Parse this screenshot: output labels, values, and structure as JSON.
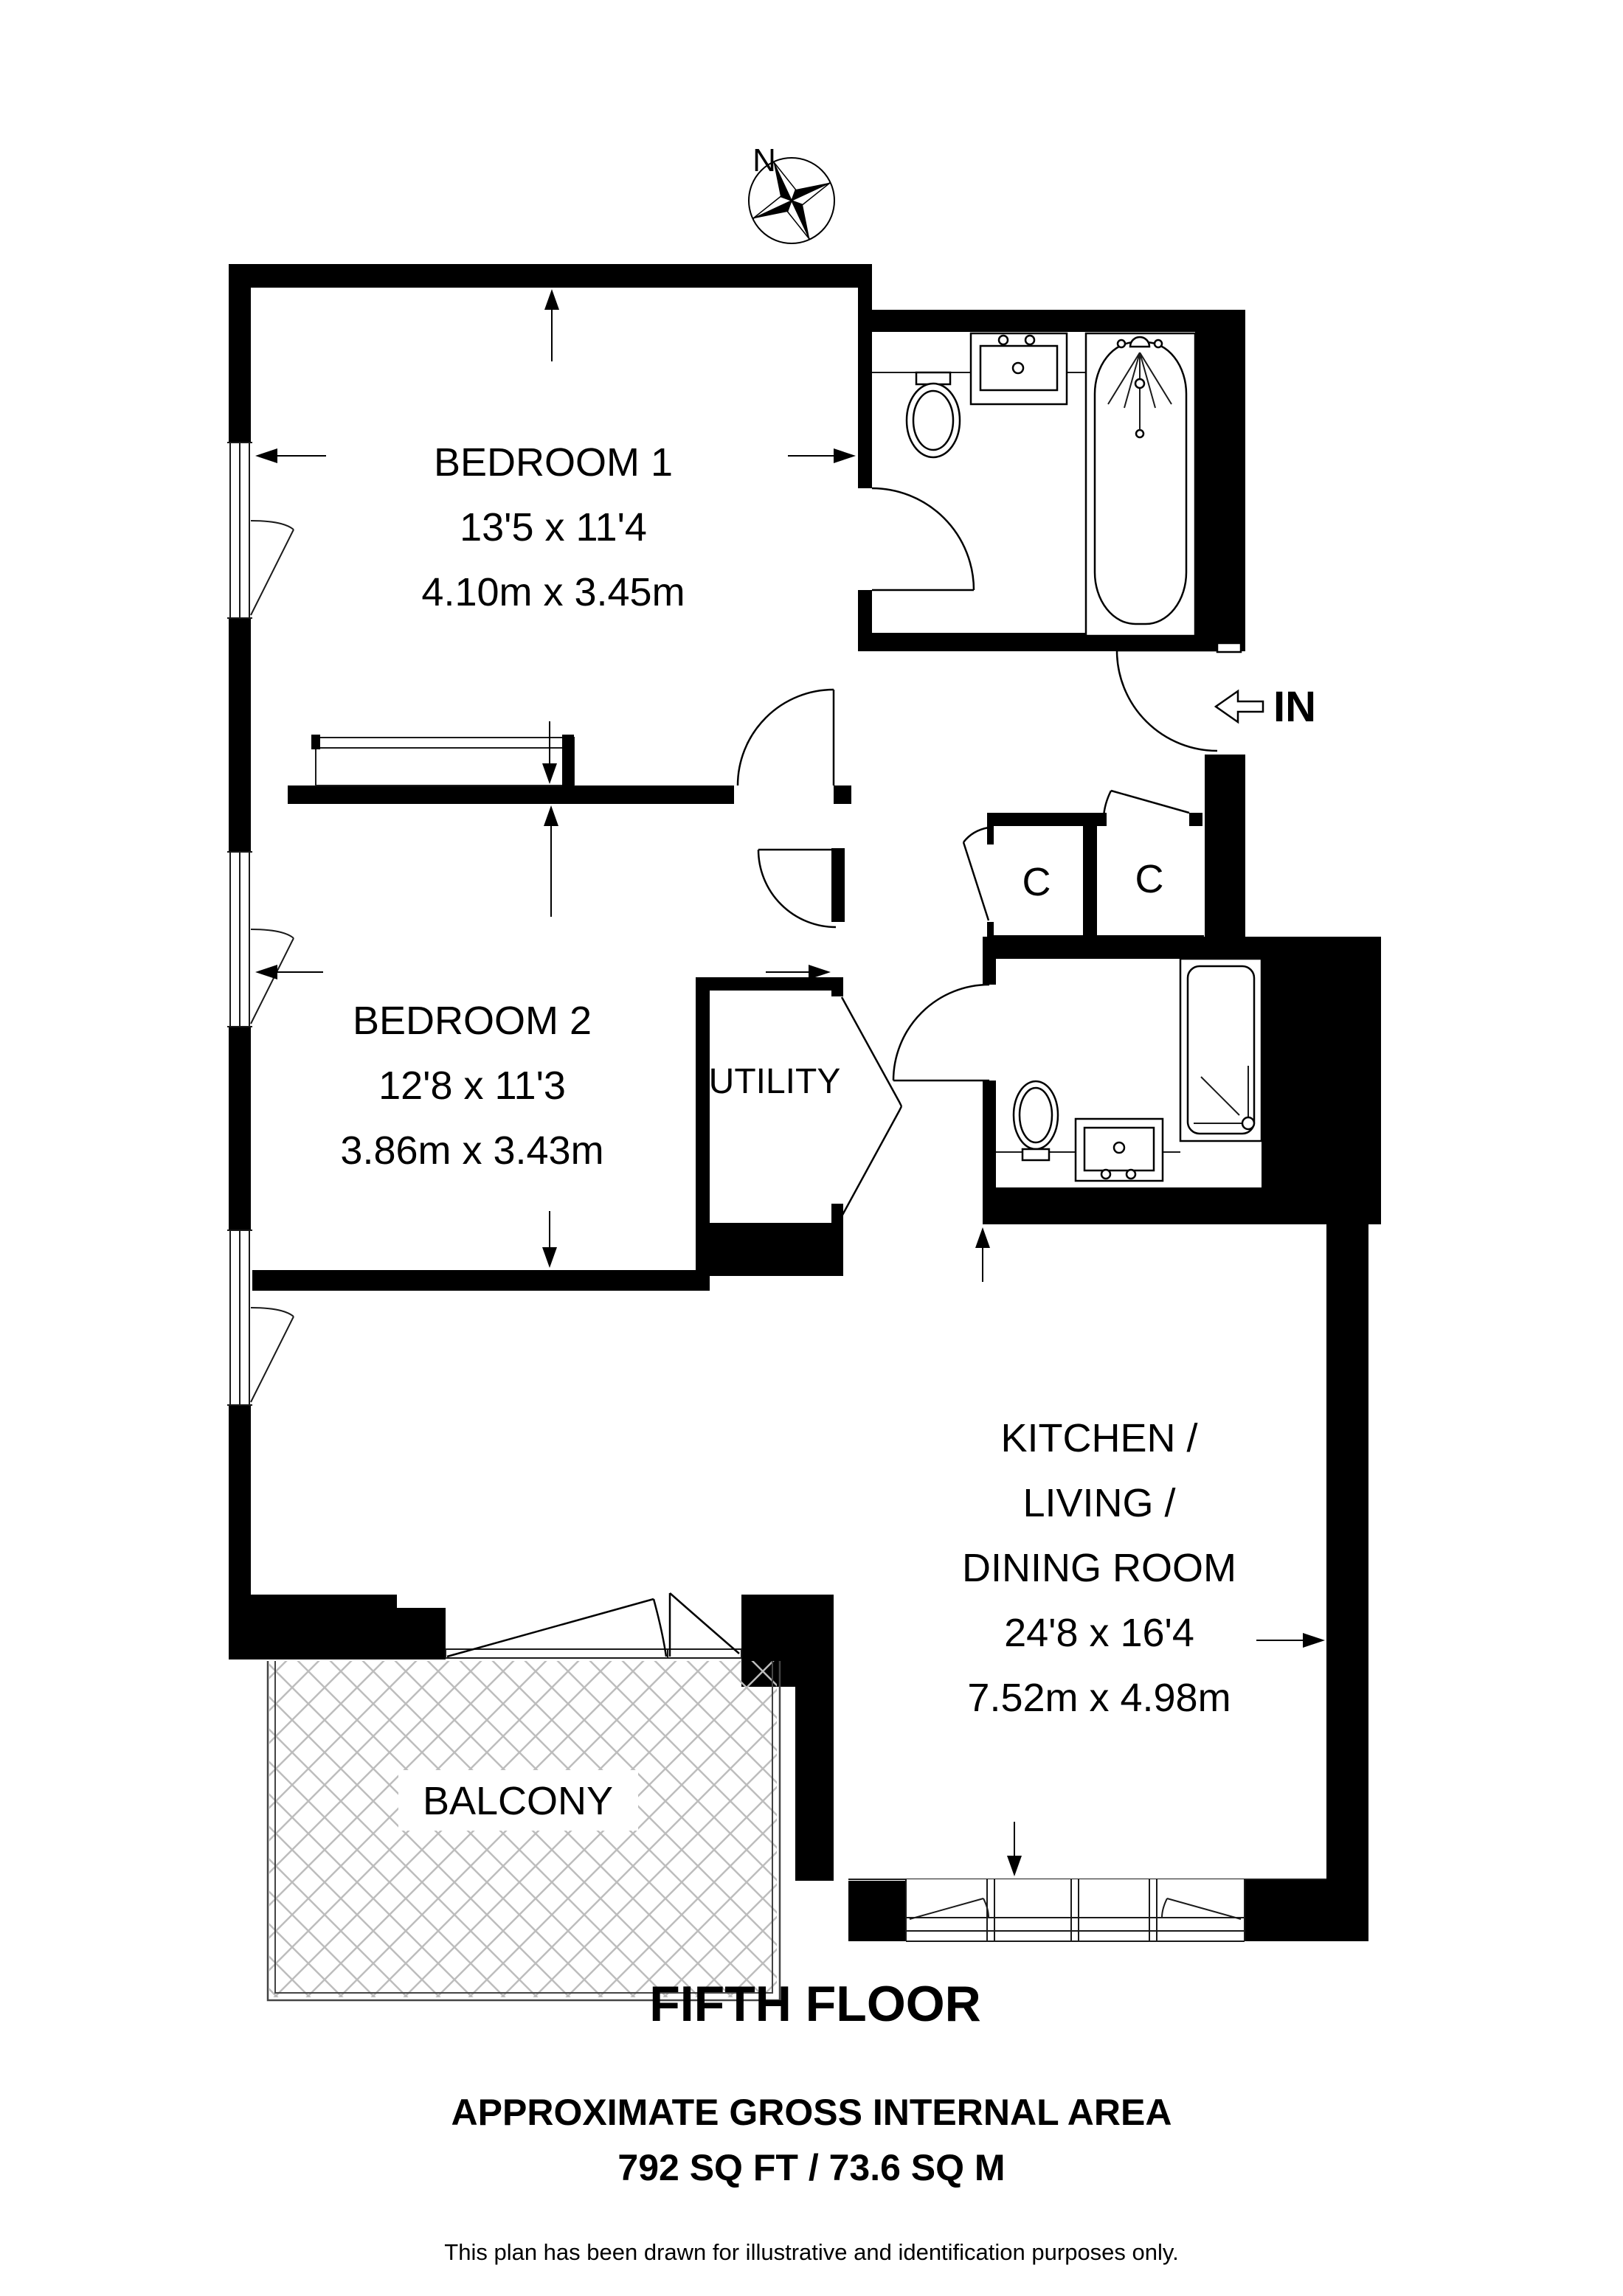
{
  "compass": {
    "north_label": "N"
  },
  "entry": {
    "label": "IN"
  },
  "rooms": {
    "bedroom1": {
      "name": "BEDROOM 1",
      "dims_imperial": "13'5 x 11'4",
      "dims_metric": "4.10m x 3.45m"
    },
    "bedroom2": {
      "name": "BEDROOM 2",
      "dims_imperial": "12'8 x 11'3",
      "dims_metric": "3.86m x 3.43m"
    },
    "kitchen": {
      "name_line1": "KITCHEN /",
      "name_line2": "LIVING /",
      "name_line3": "DINING ROOM",
      "dims_imperial": "24'8 x 16'4",
      "dims_metric": "7.52m x 4.98m"
    },
    "utility": {
      "name": "UTILITY"
    },
    "balcony": {
      "name": "BALCONY"
    },
    "cupboard_left": {
      "name": "C"
    },
    "cupboard_right": {
      "name": "C"
    }
  },
  "footer": {
    "floor_title": "FIFTH FLOOR",
    "area_heading": "APPROXIMATE GROSS INTERNAL AREA",
    "area_value": "792 SQ FT / 73.6 SQ M",
    "disclaimer": "This plan has been drawn for illustrative and identification purposes only."
  },
  "colors": {
    "walls": "#000000",
    "hatch": "#bdbdbd",
    "background": "#ffffff"
  }
}
